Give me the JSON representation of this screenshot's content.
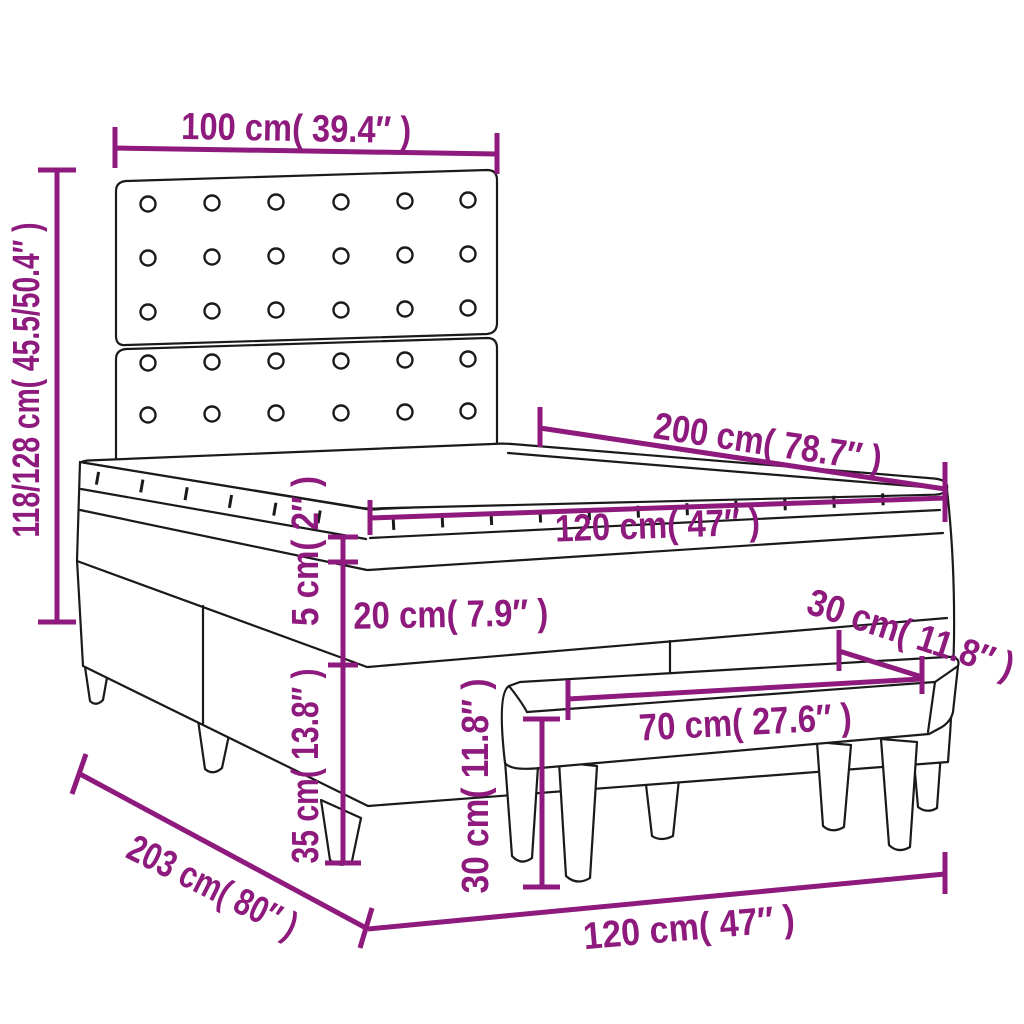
{
  "diagram": {
    "type": "product-dimension-diagram",
    "subject": "box spring bed with tufted headboard, mattress topper and bench",
    "labels": {
      "headboard_width": "100 cm( 39.4″ )",
      "total_height": "118/128 cm( 45.5/50.4″ )",
      "bed_length": "200 cm( 78.7″ )",
      "mattress_width": "120 cm( 47″ )",
      "topper_thickness": "5 cm( 2″ )",
      "mattress_height": "20 cm( 7.9″ )",
      "base_leg_height": "35 cm( 13.8″ )",
      "bench_height": "30 cm( 11.8″ )",
      "bench_depth": "30 cm( 11.8″ )",
      "bench_width": "70 cm( 27.6″ )",
      "total_length": "203 cm( 80″ )",
      "bed_width": "120 cm( 47″ )"
    },
    "colors": {
      "accent": "#8D1A7C",
      "line_art": "#1A1A1A",
      "background": "#FFFFFF"
    }
  }
}
